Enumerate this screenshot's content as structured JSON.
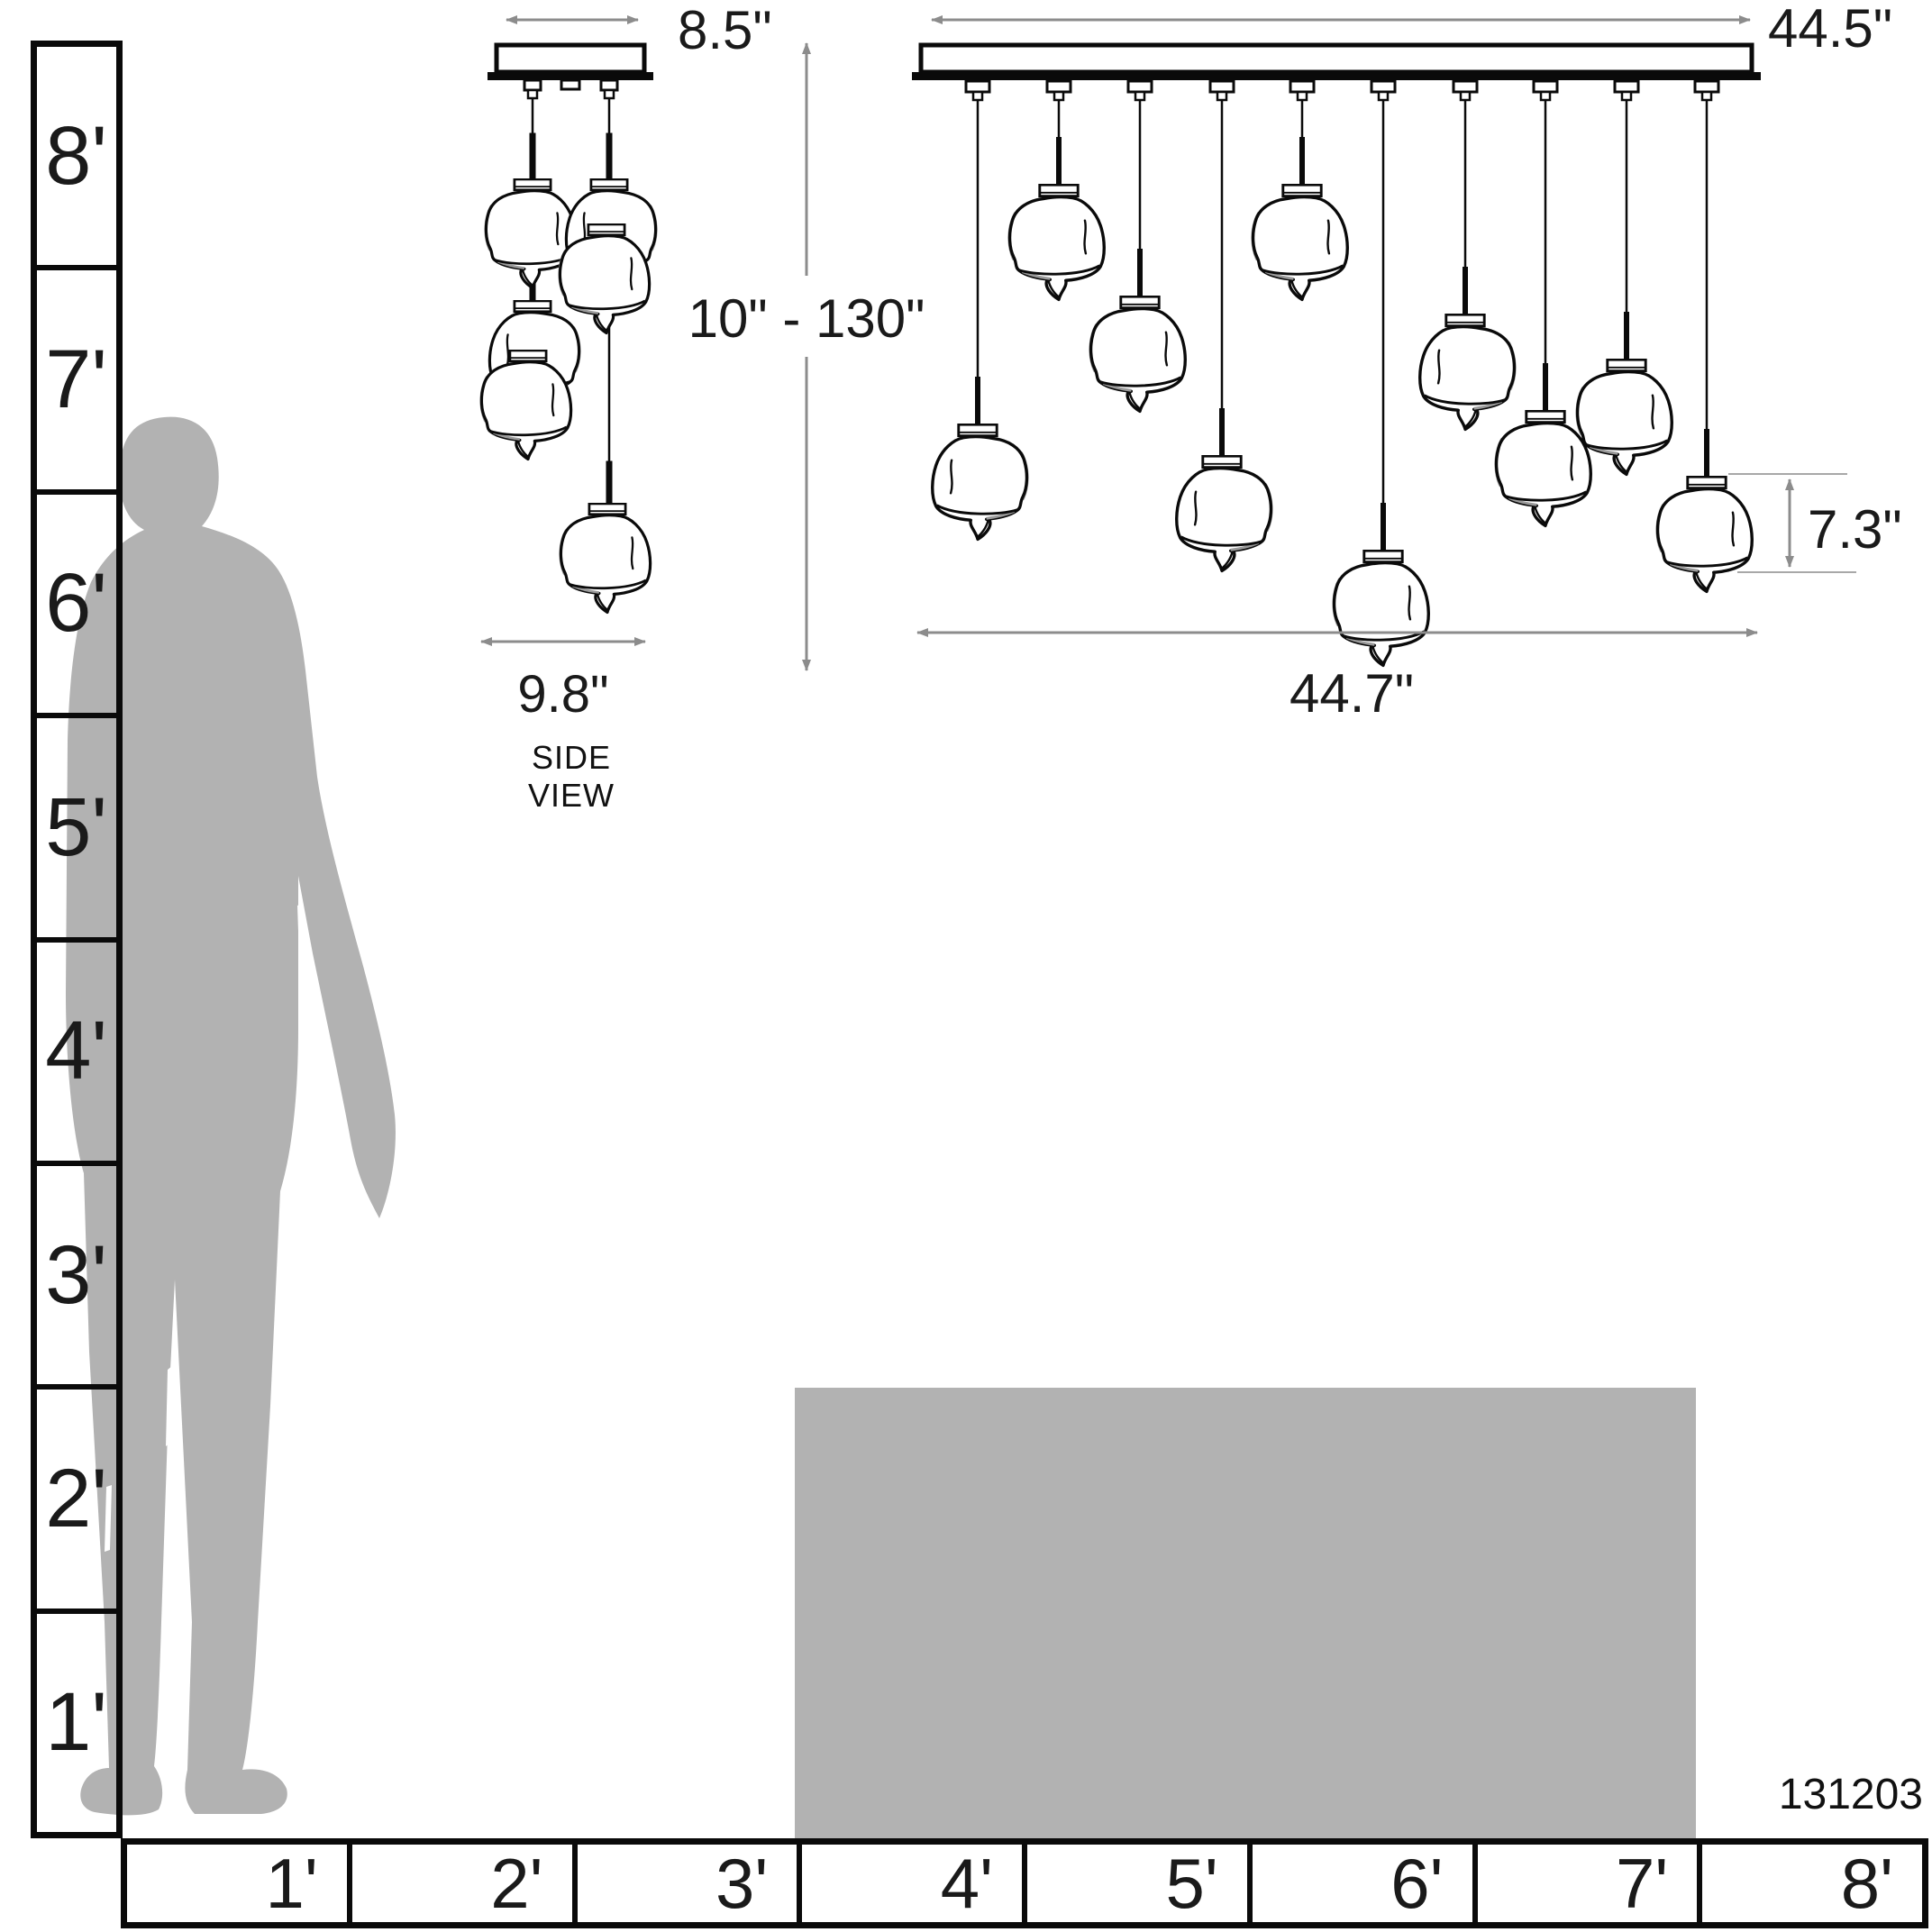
{
  "title": "Pendant chandelier dimension diagram",
  "part_number": "131203",
  "side_view": {
    "label": "SIDE VIEW",
    "canopy_width": "8.5\"",
    "suspension_range": "10\" - 130\"",
    "cluster_width": "9.8\""
  },
  "front_view": {
    "canopy_length": "44.5\"",
    "shade_height": "7.3\"",
    "overall_width": "44.7\""
  },
  "vertical_ruler": {
    "unit": "feet",
    "labels": [
      "8'",
      "7'",
      "6'",
      "5'",
      "4'",
      "3'",
      "2'",
      "1'"
    ]
  },
  "horizontal_ruler": {
    "unit": "feet",
    "labels": [
      "1'",
      "2'",
      "3'",
      "4'",
      "5'",
      "6'",
      "7'",
      "8'"
    ]
  },
  "colors": {
    "line": "#0a0a0a",
    "dimension_arrow": "#8c8c8c",
    "extension_line": "#a8a8a8",
    "silhouette_gray": "#b2b2b2",
    "island_gray": "#b2b2b2",
    "background": "#ffffff"
  }
}
